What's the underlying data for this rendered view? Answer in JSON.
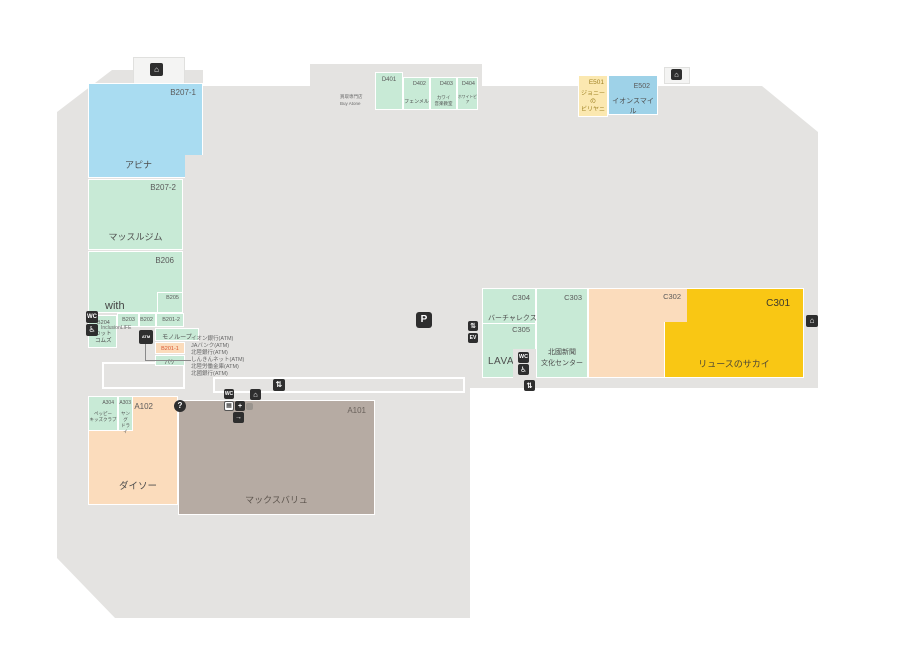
{
  "palette": {
    "floor": "#e4e3e1",
    "unit_green": "#c8ead6",
    "unit_blue": "#a9dcf1",
    "unit_blue2": "#9ed2e8",
    "unit_peach": "#fbdcbc",
    "unit_cream": "#fbe8b0",
    "unit_yellow": "#f9c714",
    "unit_brown": "#b6aba3",
    "icon_black": "#2e2e2e",
    "code_red": "#d9552e"
  },
  "units": {
    "b207_1": {
      "code": "B207-1",
      "name": "アピナ"
    },
    "b207_2": {
      "code": "B207-2",
      "name": "マッスルジム"
    },
    "b206": {
      "code": "B206",
      "name": "with"
    },
    "b205": {
      "code": "B205"
    },
    "b204": {
      "code": "B204",
      "line1": "カット",
      "line2": "コムズ"
    },
    "b203": {
      "code": "B203"
    },
    "b202": {
      "code": "B202"
    },
    "b201_2": {
      "code": "B201-2"
    },
    "monoloop": {
      "name": "モノループ"
    },
    "b201_1": {
      "code": "B201-1"
    },
    "pake": {
      "name": "パケ"
    },
    "inclusion": {
      "name": "InclusionLIFE"
    },
    "a304": {
      "code": "A304",
      "line1": "ペッピー",
      "line2": "キッズクラブ"
    },
    "a303": {
      "code": "A303",
      "line1": "ヤング",
      "line2": "ドライ"
    },
    "a102": {
      "code": "A102",
      "name": "ダイソー"
    },
    "a101": {
      "code": "A101",
      "name": "マックスバリュ"
    },
    "d401": {
      "code": "D401",
      "note1": "買取専門店",
      "note2": "Buy Atone"
    },
    "d402": {
      "code": "D402",
      "name": "フェンメル"
    },
    "d403": {
      "code": "D403",
      "line1": "カワイ",
      "line2": "音楽教室"
    },
    "d404": {
      "code": "D404",
      "name": "ホワイトピア"
    },
    "e501": {
      "code": "E501",
      "line1": "ジョニーの",
      "line2": "ビリヤニ"
    },
    "e502": {
      "code": "E502",
      "name": "イオンスマイル"
    },
    "c304": {
      "code": "C304",
      "name": "バーチャレクス"
    },
    "c305": {
      "code": "C305"
    },
    "lava": {
      "name": "LAVA"
    },
    "c303": {
      "code": "C303",
      "line1": "北國新聞",
      "line2": "文化センター"
    },
    "c302": {
      "code": "C302"
    },
    "c301": {
      "code": "C301",
      "name": "リュースのサカイ"
    }
  },
  "atm_banks": [
    "イオン銀行(ATM)",
    "JAバンク(ATM)",
    "北陸銀行(ATM)",
    "しんきんネット(ATM)",
    "北陸労働金庫(ATM)",
    "北國銀行(ATM)"
  ],
  "icons": {
    "parking": "P",
    "info": "?",
    "atm": "ATM",
    "restroom": "WC",
    "wheelchair": "♿",
    "escalator": "⇅",
    "elevator": "EV",
    "entrance": "⌂",
    "exit": "→",
    "locker": "▦",
    "aed": "+"
  }
}
